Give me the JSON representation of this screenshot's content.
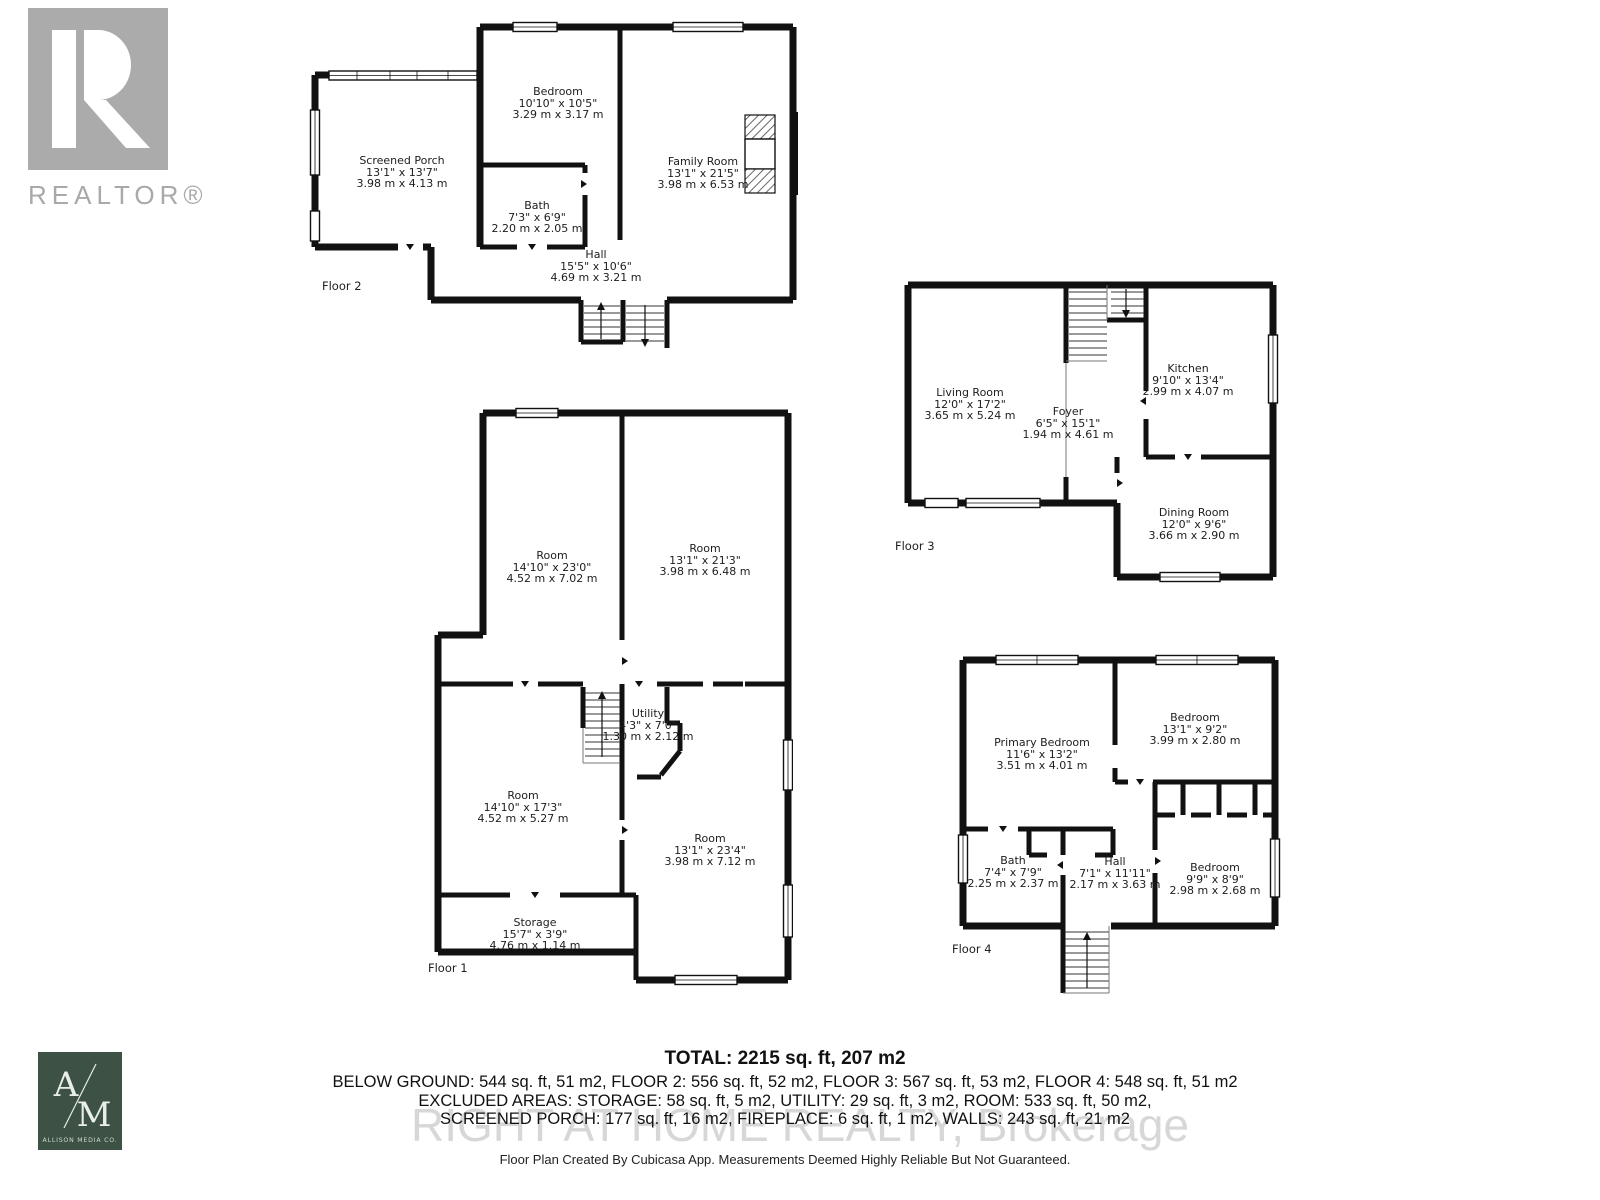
{
  "branding": {
    "realtor_logo": "REALTOR®",
    "allison_a": "A",
    "allison_m": "M",
    "allison_name": "ALLISON MEDIA CO."
  },
  "watermark": "RIGHT AT HOME REALTY, Brokerage",
  "floor2": {
    "label": "Floor 2",
    "rooms": [
      {
        "name": "Screened Porch",
        "imperial": "13'1\" x 13'7\"",
        "metric": "3.98 m x 4.13 m"
      },
      {
        "name": "Bedroom",
        "imperial": "10'10\" x 10'5\"",
        "metric": "3.29 m x 3.17 m"
      },
      {
        "name": "Bath",
        "imperial": "7'3\" x 6'9\"",
        "metric": "2.20 m x 2.05 m"
      },
      {
        "name": "Family Room",
        "imperial": "13'1\" x 21'5\"",
        "metric": "3.98 m x 6.53 m"
      },
      {
        "name": "Hall",
        "imperial": "15'5\" x 10'6\"",
        "metric": "4.69 m x 3.21 m"
      }
    ]
  },
  "floor3": {
    "label": "Floor 3",
    "rooms": [
      {
        "name": "Living Room",
        "imperial": "12'0\" x 17'2\"",
        "metric": "3.65 m x 5.24 m"
      },
      {
        "name": "Foyer",
        "imperial": "6'5\" x 15'1\"",
        "metric": "1.94 m x 4.61 m"
      },
      {
        "name": "Kitchen",
        "imperial": "9'10\" x 13'4\"",
        "metric": "2.99 m x 4.07 m"
      },
      {
        "name": "Dining Room",
        "imperial": "12'0\" x 9'6\"",
        "metric": "3.66 m x 2.90 m"
      }
    ]
  },
  "floor1": {
    "label": "Floor 1",
    "rooms": [
      {
        "name": "Room",
        "imperial": "14'10\" x 23'0\"",
        "metric": "4.52 m x 7.02 m"
      },
      {
        "name": "Room",
        "imperial": "13'1\" x 21'3\"",
        "metric": "3.98 m x 6.48 m"
      },
      {
        "name": "Utility",
        "imperial": "4'3\" x 7'0\"",
        "metric": "1.30 m x 2.12 m"
      },
      {
        "name": "Room",
        "imperial": "14'10\" x 17'3\"",
        "metric": "4.52 m x 5.27 m"
      },
      {
        "name": "Room",
        "imperial": "13'1\" x 23'4\"",
        "metric": "3.98 m x 7.12 m"
      },
      {
        "name": "Storage",
        "imperial": "15'7\" x 3'9\"",
        "metric": "4.76 m x 1.14 m"
      }
    ]
  },
  "floor4": {
    "label": "Floor 4",
    "rooms": [
      {
        "name": "Primary Bedroom",
        "imperial": "11'6\" x 13'2\"",
        "metric": "3.51 m x 4.01 m"
      },
      {
        "name": "Bedroom",
        "imperial": "13'1\" x 9'2\"",
        "metric": "3.99 m x 2.80 m"
      },
      {
        "name": "Bath",
        "imperial": "7'4\" x 7'9\"",
        "metric": "2.25 m x 2.37 m"
      },
      {
        "name": "Hall",
        "imperial": "7'1\" x 11'11\"",
        "metric": "2.17 m x 3.63 m"
      },
      {
        "name": "Bedroom",
        "imperial": "9'9\" x 8'9\"",
        "metric": "2.98 m x 2.68 m"
      }
    ]
  },
  "summary": {
    "total": "TOTAL: 2215 sq. ft, 207 m2",
    "line1": "BELOW GROUND: 544 sq. ft, 51 m2, FLOOR 2: 556 sq. ft, 52 m2, FLOOR 3: 567 sq. ft, 53 m2, FLOOR 4: 548 sq. ft, 51 m2",
    "line2": "EXCLUDED AREAS: STORAGE: 58 sq. ft, 5 m2, UTILITY: 29 sq. ft, 3 m2, ROOM: 533 sq. ft, 50 m2,",
    "line3": "SCREENED PORCH: 177 sq. ft, 16 m2, FIREPLACE: 6 sq. ft, 1 m2, WALLS: 243 sq. ft, 21 m2"
  },
  "footer": "Floor Plan Created By Cubicasa App. Measurements Deemed Highly Reliable But Not Guaranteed.",
  "colors": {
    "wall": "#111111",
    "text": "#1d1d1d",
    "realtor_gray": "#ababab",
    "allison_green": "#3d5244",
    "watermark": "#b7b7b7"
  }
}
